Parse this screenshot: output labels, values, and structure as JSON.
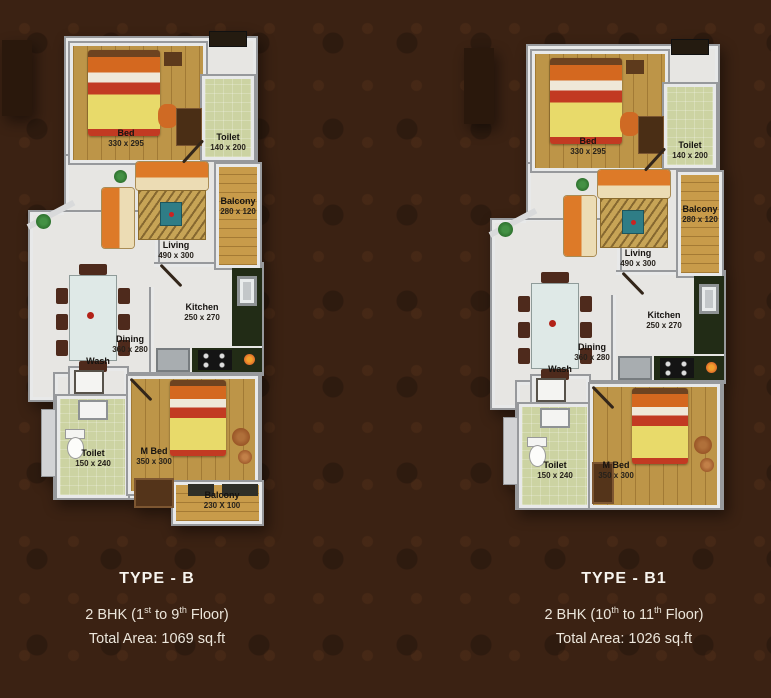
{
  "page": {
    "background_color": "#3b2213",
    "text_color": "#ece6db"
  },
  "colors": {
    "wall": "#e8e9e9",
    "wall_edge": "#97999c",
    "floor_light": "#e7e6e3",
    "floor_wood": "#bd9548",
    "floor_balcony": "#c89b4a",
    "floor_toilet": "#ccd3a2",
    "kitchen_counter": "#222c16",
    "sofa_orange": "#dd7a28",
    "bed_blanket_yellow": "#e8da6a",
    "bed_stripe_red": "#c23a22"
  },
  "plans": [
    {
      "title": "TYPE - B",
      "floor_line": {
        "pre": "2 BHK (1",
        "sup1": "st",
        "mid": " to 9",
        "sup2": "th",
        "post": " Floor)"
      },
      "area_line": "Total Area: 1069 sq.ft",
      "rooms": {
        "bed": {
          "name": "Bed",
          "dims": "330 x 295"
        },
        "toilet_top": {
          "name": "Toilet",
          "dims": "140 x 200"
        },
        "balcony_right": {
          "name": "Balcony",
          "dims": "280 x 120"
        },
        "living": {
          "name": "Living",
          "dims": "490 x 300"
        },
        "kitchen": {
          "name": "Kitchen",
          "dims": "250 x 270"
        },
        "dining": {
          "name": "Dining",
          "dims": "360 x 280"
        },
        "wash": {
          "name": "Wash"
        },
        "toilet_bottom": {
          "name": "Toilet",
          "dims": "150 x 240"
        },
        "m_bed": {
          "name": "M Bed",
          "dims": "350 x 300"
        },
        "balcony_bottom": {
          "name": "Balcony",
          "dims": "230 X 100"
        }
      }
    },
    {
      "title": "TYPE - B1",
      "floor_line": {
        "pre": "2 BHK (10",
        "sup1": "th",
        "mid": " to 11",
        "sup2": "th",
        "post": " Floor)"
      },
      "area_line": "Total Area: 1026 sq.ft",
      "rooms": {
        "bed": {
          "name": "Bed",
          "dims": "330 x 295"
        },
        "toilet_top": {
          "name": "Toilet",
          "dims": "140 x 200"
        },
        "balcony_right": {
          "name": "Balcony",
          "dims": "280 x 120"
        },
        "living": {
          "name": "Living",
          "dims": "490 x 300"
        },
        "kitchen": {
          "name": "Kitchen",
          "dims": "250 x 270"
        },
        "dining": {
          "name": "Dining",
          "dims": "360 x 280"
        },
        "wash": {
          "name": "Wash"
        },
        "toilet_bottom": {
          "name": "Toilet",
          "dims": "150 x 240"
        },
        "m_bed": {
          "name": "M Bed",
          "dims": "350 x 300"
        }
      }
    }
  ]
}
